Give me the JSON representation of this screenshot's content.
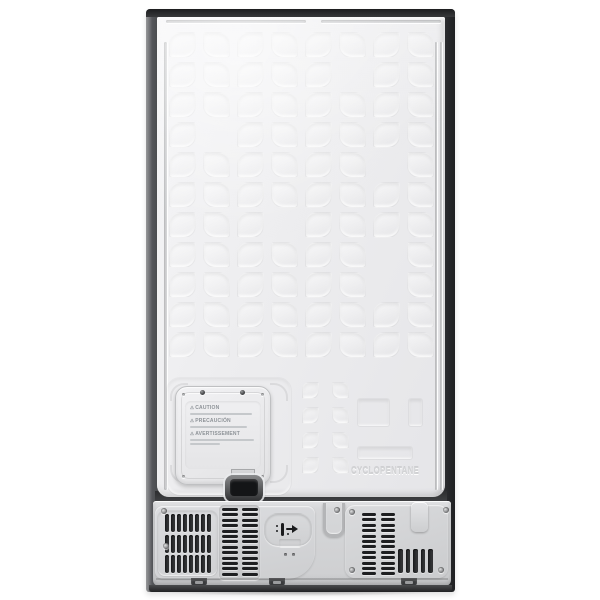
{
  "fridge": {
    "rear_panel": {
      "embossed_material_text": "CYCLOPENTANE"
    },
    "access_panel_label": {
      "warning_symbol": "⚠",
      "warnings": [
        {
          "icon": "warning-triangle-icon",
          "title": "CAUTION"
        },
        {
          "icon": "warning-triangle-icon",
          "title": "PRECAUCIÓN"
        },
        {
          "icon": "warning-triangle-icon",
          "title": "AVERTISSEMENT"
        }
      ]
    },
    "icons": {
      "power_cord_anchor": "plug-icon",
      "fasteners": "screw-icon",
      "cord_hook": "hook-icon"
    },
    "colors": {
      "background": "#ffffff",
      "panel_light": "#f4f4f6",
      "panel": "#ebecee",
      "frame_dark": "#3b3c3e",
      "cover_metal": "#d3d4d6",
      "vent_slot_dark": "#222325",
      "clip_black": "#17181a",
      "embossed_text": "#d2d3d5"
    }
  }
}
